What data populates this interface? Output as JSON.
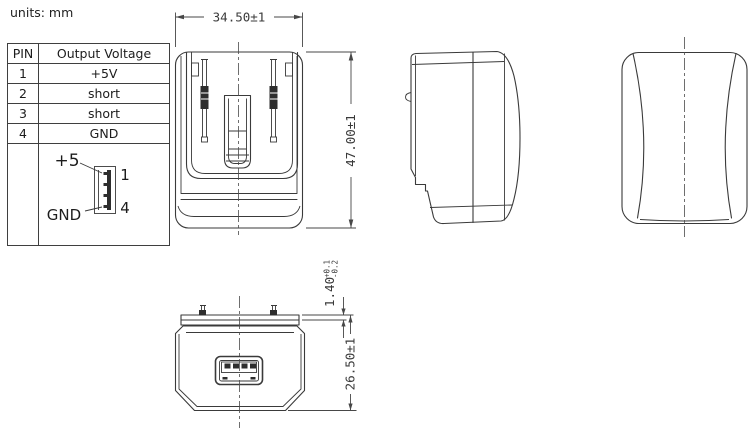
{
  "units_label": "units: mm",
  "colors": {
    "background": "#ffffff",
    "line": "#3a3a3a",
    "dimension": "#474747",
    "text": "#1c1c1c"
  },
  "pin_table": {
    "headers": {
      "pin": "PIN",
      "voltage": "Output Voltage"
    },
    "rows": [
      {
        "pin": "1",
        "voltage": "+5V"
      },
      {
        "pin": "2",
        "voltage": "short"
      },
      {
        "pin": "3",
        "voltage": "short"
      },
      {
        "pin": "4",
        "voltage": "GND"
      }
    ]
  },
  "pinout": {
    "positive_label": "+5",
    "ground_label": "GND",
    "first_pin": "1",
    "last_pin": "4"
  },
  "dimensions": {
    "body_width": "34.50±1",
    "body_height": "47.00±1",
    "plug_lip_thickness": "1.40",
    "plug_lip_tol_upper": "+0.1",
    "plug_lip_tol_lower": "-0.2",
    "body_depth": "26.50±1"
  }
}
